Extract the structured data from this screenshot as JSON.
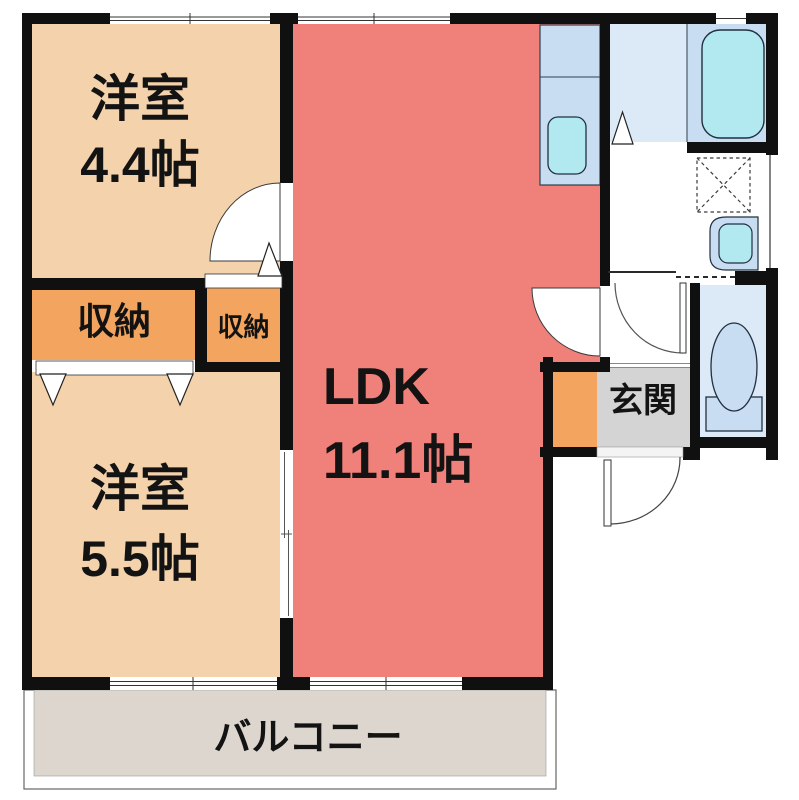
{
  "plan": {
    "rooms": {
      "western_room_top": {
        "name": "洋室",
        "size": "4.4帖"
      },
      "western_room_bottom": {
        "name": "洋室",
        "size": "5.5帖"
      },
      "ldk": {
        "name": "LDK",
        "size": "11.1帖"
      },
      "closet_left": {
        "label": "収納"
      },
      "closet_right": {
        "label": "収納"
      },
      "entrance": {
        "label": "玄関"
      },
      "balcony": {
        "label": "バルコニー"
      }
    },
    "fixtures": [
      "kitchen-sink",
      "bathtub",
      "washing-machine-pan",
      "vanity-sink",
      "toilet",
      "shoe-cabinet"
    ],
    "colors": {
      "wall": "#101010",
      "room_peach": "#f3d2ac",
      "closet_orange": "#f3a45e",
      "ldk_red": "#f0807a",
      "balcony_beige": "#dcd6ce",
      "genkan_gray": "#d4d4d4",
      "bath_floor_blue": "#dce9f7",
      "water_blue": "#c9ddf2",
      "fixture_cyan": "#b2e9f1",
      "line_dark": "#2e3f51"
    }
  }
}
